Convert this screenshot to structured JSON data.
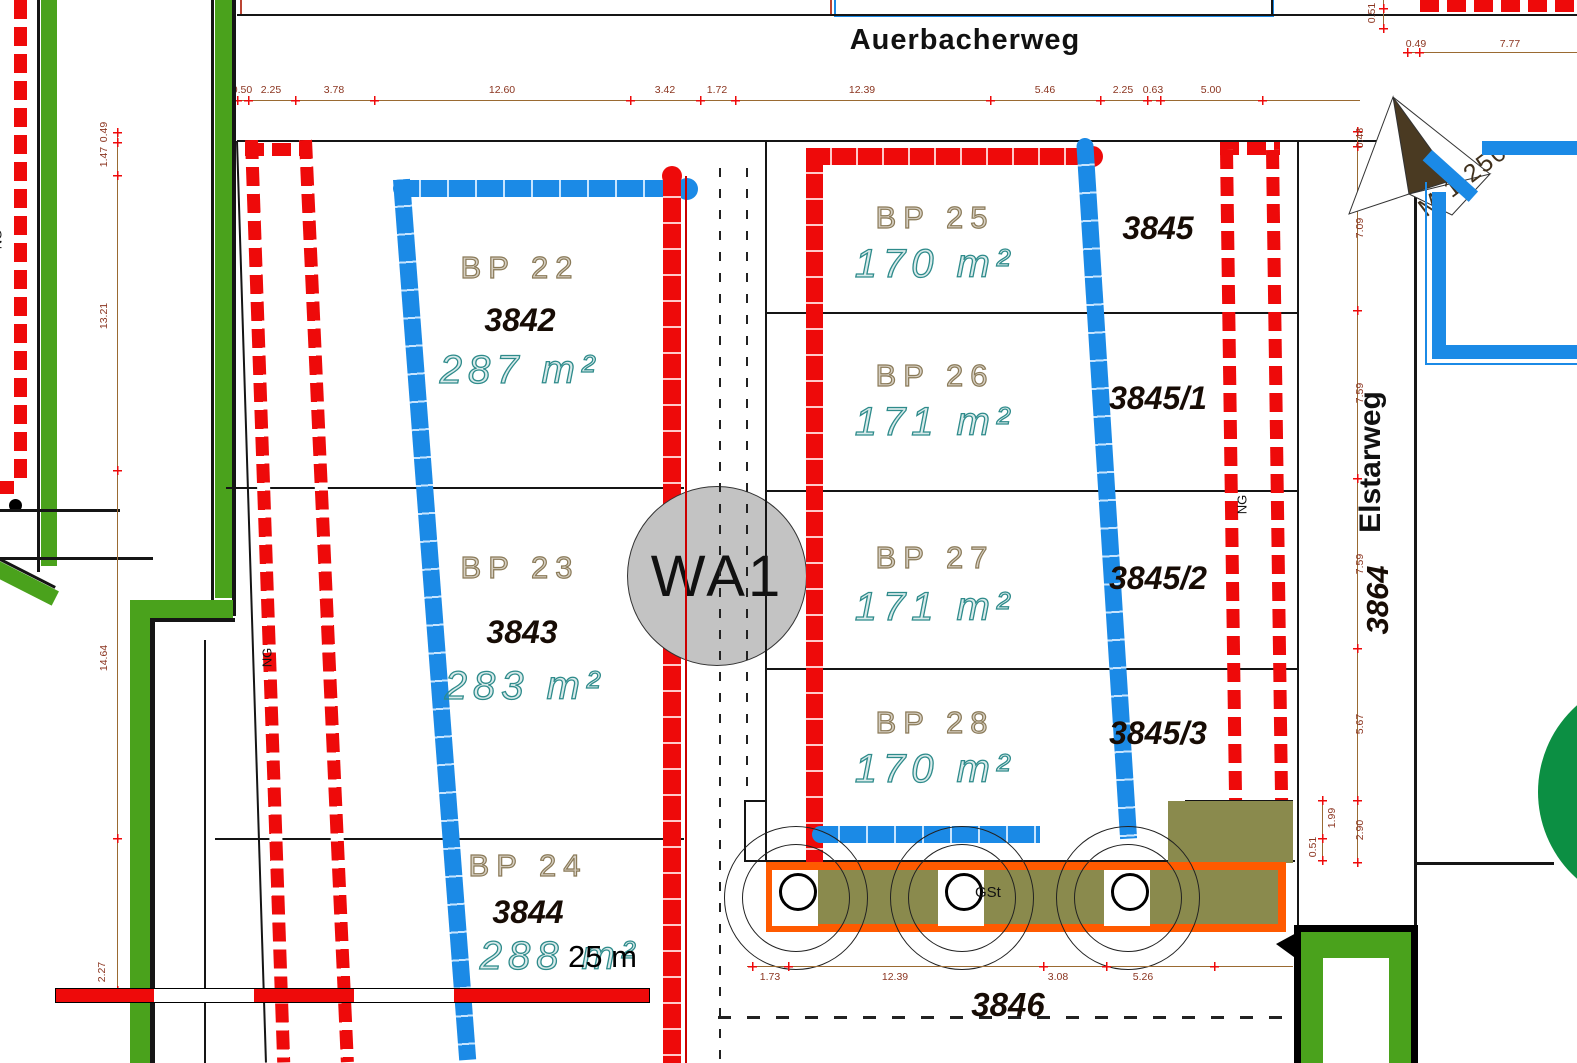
{
  "colors": {
    "red": "#ee0a0a",
    "blue": "#1b8ae6",
    "green_strip": "#4aa21c",
    "green_dark": "#0c8f43",
    "olive": "#8a8a4d",
    "orange": "#ff5a00",
    "gray_zone": "#c3c3c3",
    "teal": "#2e8b8b",
    "label_brown": "#8a7a58",
    "dim_line": "#9a6a32",
    "dim_text": "#8b3520"
  },
  "streets": {
    "top": "Auerbacherweg",
    "right": "Elstarweg"
  },
  "zone": {
    "label": "WA1"
  },
  "scale": {
    "north_label": "M 1:250",
    "bar_label": "25 m"
  },
  "annotations": {
    "ng": "NG",
    "gst": "GSt"
  },
  "parcels": {
    "left": [
      {
        "bp": "BP 22",
        "nr": "3842",
        "area": "287 m²"
      },
      {
        "bp": "BP 23",
        "nr": "3843",
        "area": "283 m²"
      },
      {
        "bp": "BP 24",
        "nr": "3844",
        "area": "288 m²"
      }
    ],
    "right": [
      {
        "bp": "BP 25",
        "area": "170 m²",
        "nr": "3845"
      },
      {
        "bp": "BP 26",
        "area": "171 m²",
        "nr": "3845/1"
      },
      {
        "bp": "BP 27",
        "area": "171 m²",
        "nr": "3845/2"
      },
      {
        "bp": "BP 28",
        "area": "170 m²",
        "nr": "3845/3"
      }
    ],
    "south": "3846",
    "east": "3864"
  },
  "dimensions": {
    "top": [
      "0.50",
      "2.25",
      "3.78",
      "12.60",
      "3.42",
      "1.72",
      "12.39",
      "5.46",
      "2.25",
      "0.63",
      "5.00"
    ],
    "left": [
      "0.49",
      "1.47",
      "13.21",
      "14.64",
      "2.27"
    ],
    "right": [
      "0.48",
      "7.09",
      "7.59",
      "7.59",
      "5.67",
      "2.90",
      "1.99",
      "0.51"
    ],
    "bottom": [
      "1.73",
      "12.39",
      "3.08",
      "5.26"
    ],
    "top_right": [
      "0.51",
      "0.49",
      "7.77"
    ]
  }
}
